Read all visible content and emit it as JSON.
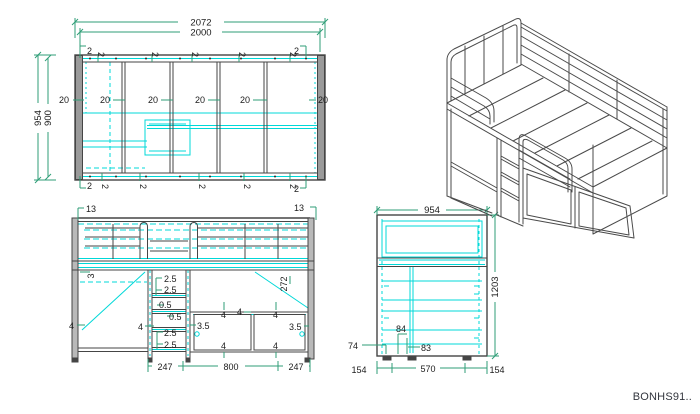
{
  "meta": {
    "code": "BONHS91.."
  },
  "colors": {
    "outline": "#454545",
    "hidden_lines": "#00d8d8",
    "dimension_lines": "#2f9e77",
    "text": "#1c1c1c",
    "panel_fill": "#9a9a9a"
  },
  "top_view": {
    "total_width": "2072",
    "inner_width": "2000",
    "total_depth": "954",
    "inner_depth": "900",
    "t20": [
      "20",
      "20",
      "20",
      "20",
      "20",
      "20"
    ],
    "top2": [
      "2",
      "2",
      "2",
      "2",
      "2",
      "2",
      "2"
    ],
    "bot2": [
      "2",
      "2",
      "2",
      "2",
      "2",
      "2",
      "2"
    ]
  },
  "front_view": {
    "left13": "13",
    "right13": "13",
    "v3": "3",
    "left4": "4",
    "mid4": "4",
    "s25a": "2.5",
    "s25b": "2.5",
    "s05a": "0.5",
    "s05b": "0.5",
    "s25c": "2.5",
    "s25d": "2.5",
    "gap35l": "3.5",
    "gap35r": "3.5",
    "h272": "272",
    "d4": [
      "4",
      "4",
      "4",
      "4",
      "4"
    ],
    "b247l": "247",
    "b800": "800",
    "b247r": "247"
  },
  "side_view": {
    "w954": "954",
    "h1203": "1203",
    "f74": "74",
    "f84": "84",
    "f83": "83",
    "b154l": "154",
    "b570": "570",
    "b154r": "154"
  }
}
